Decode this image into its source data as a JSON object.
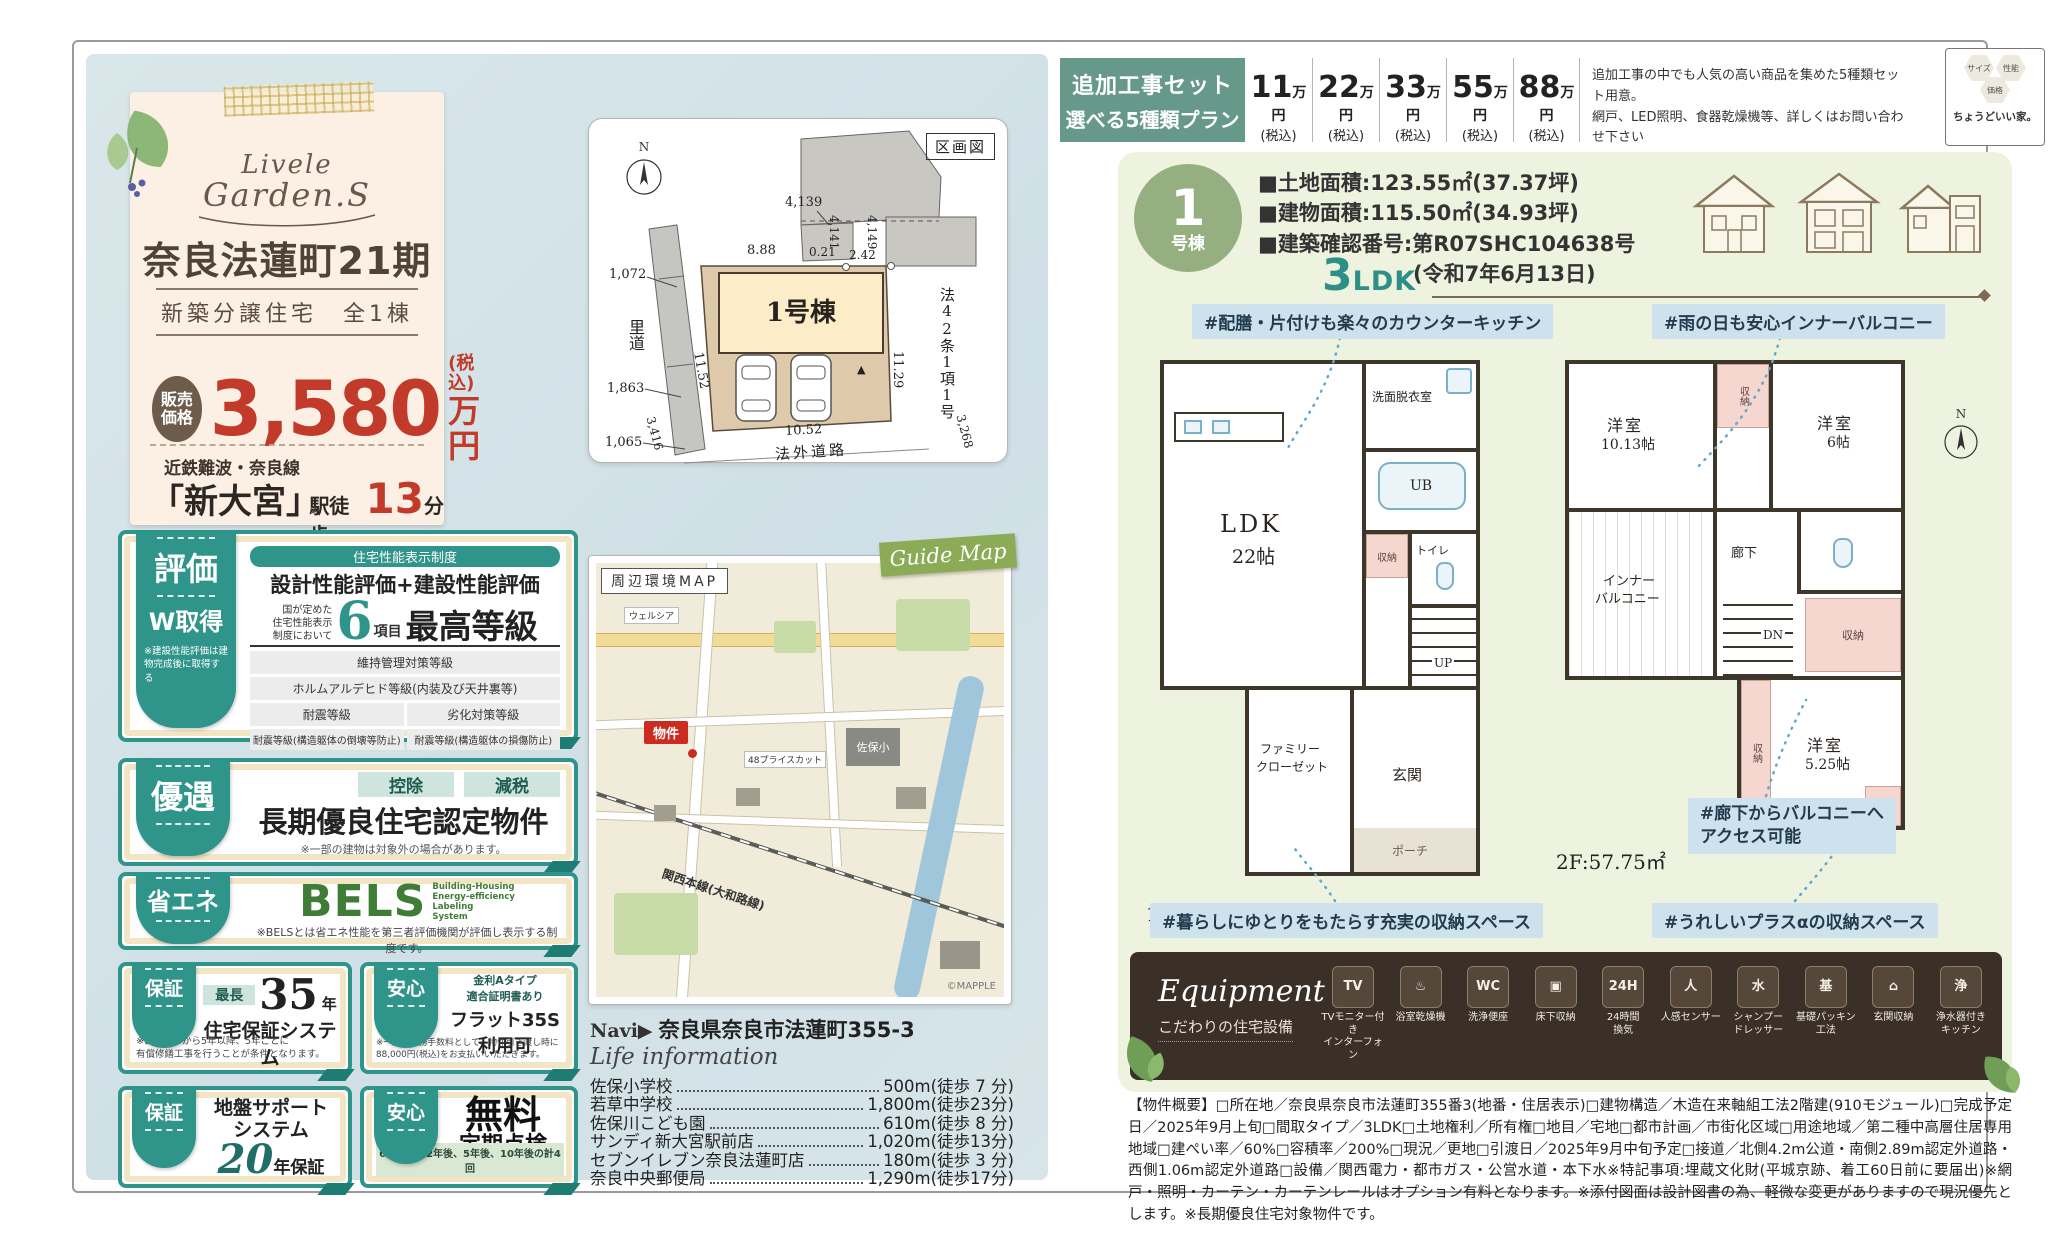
{
  "top_bar": {
    "plan_box": {
      "line1": "追加工事セット",
      "line2": "選べる5種類プラン"
    },
    "prices": [
      {
        "amount": "11",
        "unit": "万円",
        "tax": "(税込)"
      },
      {
        "amount": "22",
        "unit": "万円",
        "tax": "(税込)"
      },
      {
        "amount": "33",
        "unit": "万円",
        "tax": "(税込)"
      },
      {
        "amount": "55",
        "unit": "万円",
        "tax": "(税込)"
      },
      {
        "amount": "88",
        "unit": "万円",
        "tax": "(税込)"
      }
    ],
    "note_line1": "追加工事の中でも人気の高い商品を集めた5種類セット用意。",
    "note_line2": "網戸、LED照明、食器乾燥機等、詳しくはお問い合わせ下さい",
    "brand": {
      "hex1": "サイズ",
      "hex2": "性能",
      "hex3": "価格",
      "tagline": "ちょうどいい家。"
    }
  },
  "main_card": {
    "logo_line1": "Livele",
    "logo_line2": "Garden.S",
    "title": "奈良法蓮町21期",
    "subtitle": "新築分譲住宅　全1棟",
    "price_badge1": "販売",
    "price_badge2": "価格",
    "price": "3,580",
    "tax": "(税込)",
    "unit": "万円",
    "rail": "近鉄難波・奈良線",
    "station": "「新大宮」",
    "walk_prefix": "駅徒歩",
    "walk_min": "13",
    "walk_suffix": "分"
  },
  "plot_map": {
    "title": "区画図",
    "compass_n": "N",
    "building": "1号棟",
    "satodou": "里道",
    "outer_road": "法外道路",
    "law": "法42条1項1号",
    "tri": "▲",
    "d_4139": "4,139",
    "d_888": "8.88",
    "d_021": "0.21",
    "d_242": "2.42",
    "d_4141": "4,141",
    "d_4149": "4,149",
    "d_1072": "1,072",
    "d_1863": "1,863",
    "d_1065": "1,065",
    "d_1152": "11.52",
    "d_1129": "11.29",
    "d_3416": "3,416",
    "d_1052": "10.52",
    "d_3268": "3,268"
  },
  "badges": {
    "hyouka": {
      "tab": "評価",
      "tab_sub": "W取得",
      "tab_note": "※建設性能評価は建物完成後に取得する",
      "panel_header": "住宅性能表示制度",
      "panel_title": "設計性能評価+建設性能評価",
      "lead1": "国が定めた",
      "lead2": "住宅性能表示",
      "lead3": "制度において",
      "big_num": "6",
      "big_suffix": "項目",
      "big_text": "最高等級",
      "row1": "維持管理対策等級",
      "row2": "ホルムアルデヒド等級(内装及び天井裏等)",
      "cell1": "耐震等級",
      "cell2": "劣化対策等級",
      "cell3": "耐震等級(構造躯体の倒壊等防止)",
      "cell4": "耐震等級(構造躯体の損傷防止)"
    },
    "yuuguu": {
      "tab": "優遇",
      "pill1": "控除",
      "pill2": "減税",
      "title": "長期優良住宅認定物件",
      "note": "※一部の建物は対象外の場合があります。"
    },
    "shouene": {
      "tab": "省エネ",
      "logo": "BELS",
      "sub1": "Building-Housing",
      "sub2": "Energy-efficiency",
      "sub3": "Labeling",
      "sub4": "System",
      "note": "※BELSとは省エネ性能を第三者評価機関が評価し表示する制度です。"
    },
    "hoshou35": {
      "tab": "保証",
      "pill": "最長",
      "num": "35",
      "num_suffix": "年",
      "title": "住宅保証システム",
      "note1": "※お引渡しから5年以降、5年ごとに",
      "note2": "有償修繕工事を行うことが条件となります。"
    },
    "anshin35s": {
      "tab": "安心",
      "pill1": "金利Aタイプ",
      "pill2": "適合証明書あり",
      "title": "フラット35S利用可",
      "note1": "※一連の事務手数料として、物件引き渡し時に",
      "note2": "88,000円(税込)をお支払いいただきます。"
    },
    "jiban": {
      "tab": "保証",
      "title1": "地盤サポート",
      "title2": "システム",
      "num": "20",
      "num_suffix": "年保証"
    },
    "tenken": {
      "tab": "安心",
      "title1": "無料",
      "title2": "定期点検",
      "footer": "6ヶ月後、2年後、5年後、10年後の計4回"
    }
  },
  "guide_map": {
    "corner_label": "周辺環境MAP",
    "ribbon": "Guide Map",
    "marker": "物件",
    "label_welcia": "ウェルシア",
    "label_school": "佐保小",
    "label_store": "48プライスカット",
    "label_rail": "関西本線(大和路線)",
    "credit": "©MAPPLE"
  },
  "navi": {
    "label": "Navi▶",
    "address": "奈良県奈良市法蓮町355-3"
  },
  "life_info": {
    "title": "Life information",
    "rows": [
      {
        "name": "佐保小学校",
        "value": "500m(徒歩 7 分)"
      },
      {
        "name": "若草中学校",
        "value": "1,800m(徒歩23分)"
      },
      {
        "name": "佐保川こども園",
        "value": "610m(徒歩 8 分)"
      },
      {
        "name": "サンディ新大宮駅前店",
        "value": "1,020m(徒歩13分)"
      },
      {
        "name": "セブンイレブン奈良法蓮町店",
        "value": "180m(徒歩 3 分)"
      },
      {
        "name": "奈良中央郵便局",
        "value": "1,290m(徒歩17分)"
      }
    ]
  },
  "unit": {
    "num": "1",
    "suffix": "号棟",
    "spec1": "■土地面積:123.55㎡(37.37坪)",
    "spec2": "■建物面積:115.50㎡(34.93坪)",
    "spec3": "■建築確認番号:第R07SHC104638号",
    "spec4": "(令和7年6月13日)",
    "ldk_num": "3",
    "ldk_suffix": "LDK"
  },
  "floorplan": {
    "compass": "N",
    "f1_area": "1F:57.75㎡",
    "f2_area": "2F:57.75㎡",
    "tags": {
      "kitchen": "#配膳・片付けも楽々のカウンターキッチン",
      "balcony": "#雨の日も安心インナーバルコニー",
      "hall1": "#廊下からバルコニーへ",
      "hall2": "アクセス可能",
      "storage1": "#暮らしにゆとりをもたらす充実の収納スペース",
      "storage2": "#うれしいプラスαの収納スペース"
    },
    "f1": {
      "ldk": "LDK",
      "ldk_size": "22帖",
      "senmen": "洗面脱衣室",
      "ub": "UB",
      "shuno": "収納",
      "toilet": "トイレ",
      "up": "UP",
      "genkan": "玄関",
      "fcl1": "ファミリー",
      "fcl2": "クローゼット",
      "porch": "ポーチ"
    },
    "f2": {
      "yo1": "洋室",
      "yo1s": "10.13帖",
      "yo2": "洋室",
      "yo2s": "6帖",
      "inner1": "インナー",
      "inner2": "バルコニー",
      "rouka": "廊下",
      "dn": "DN",
      "yo3": "洋室",
      "yo3s": "5.25帖",
      "s1": "収納",
      "s2": "収納",
      "s3": "収納",
      "s4": "収納"
    }
  },
  "equipment": {
    "title": "Equipment",
    "subtitle": "こだわりの住宅設備",
    "items": [
      {
        "icon": "TV",
        "l1": "TVモニター付き",
        "l2": "インターフォン"
      },
      {
        "icon": "♨",
        "l1": "浴室乾燥機",
        "l2": ""
      },
      {
        "icon": "WC",
        "l1": "洗浄便座",
        "l2": ""
      },
      {
        "icon": "▣",
        "l1": "床下収納",
        "l2": ""
      },
      {
        "icon": "24H",
        "l1": "24時間",
        "l2": "換気"
      },
      {
        "icon": "人",
        "l1": "人感センサー",
        "l2": ""
      },
      {
        "icon": "水",
        "l1": "シャンプー",
        "l2": "ドレッサー"
      },
      {
        "icon": "基",
        "l1": "基礎パッキン",
        "l2": "工法"
      },
      {
        "icon": "⌂",
        "l1": "玄関収納",
        "l2": ""
      },
      {
        "icon": "浄",
        "l1": "浄水器付き",
        "l2": "キッチン"
      }
    ]
  },
  "outline": {
    "text": "【物件概要】□所在地／奈良県奈良市法蓮町355番3(地番・住居表示)□建物構造／木造在来軸組工法2階建(910モジュール)□完成予定日／2025年9月上旬□間取タイプ／3LDK□土地権利／所有権□地目／宅地□都市計画／市街化区域□用途地域／第二種中高層住居専用地域□建ぺい率／60%□容積率／200%□現況／更地□引渡日／2025年9月中旬予定□接道／北側4.2m公道・南側2.89m認定外道路・西側1.06m認定外道路□設備／関西電力・都市ガス・公営水道・本下水※特記事項:埋蔵文化財(平城京跡、着工60日前に要届出)※網戸・照明・カーテン・カーテンレールはオプション有料となります。※添付図面は設計図書の為、軽微な変更がありますので現況優先とします。※長期優良住宅対象物件です。"
  }
}
